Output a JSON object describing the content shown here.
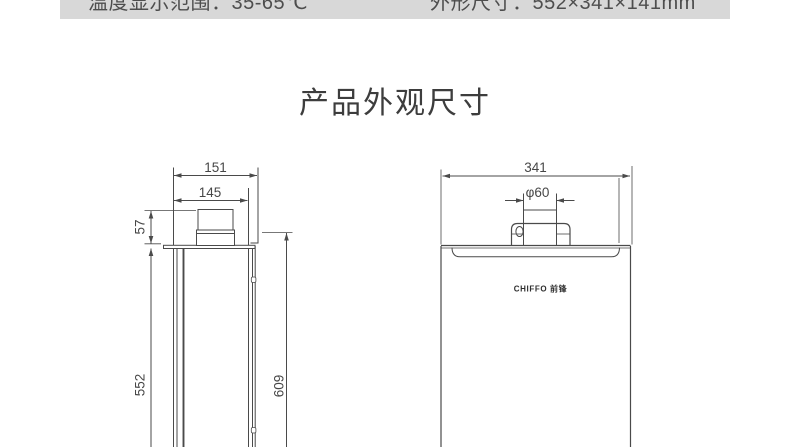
{
  "spec_bar": {
    "temp_range_label": "温度显示范围：35-65℃",
    "outer_size_label": "外形尺寸：552×341×141mm",
    "bg_color": "#d8d8d8",
    "text_color": "#4e4e4e"
  },
  "title": "产品外观尺寸",
  "diagram": {
    "line_color": "#4a4a4a",
    "side_view": {
      "depth_overall_mm": "151",
      "depth_body_mm": "145",
      "flue_height_mm": "57",
      "body_height_mm": "552",
      "overall_height_mm": "609"
    },
    "front_view": {
      "width_overall_mm": "341",
      "flue_diameter": "φ60",
      "brand_logo": "CHIFFO 前锋"
    }
  }
}
